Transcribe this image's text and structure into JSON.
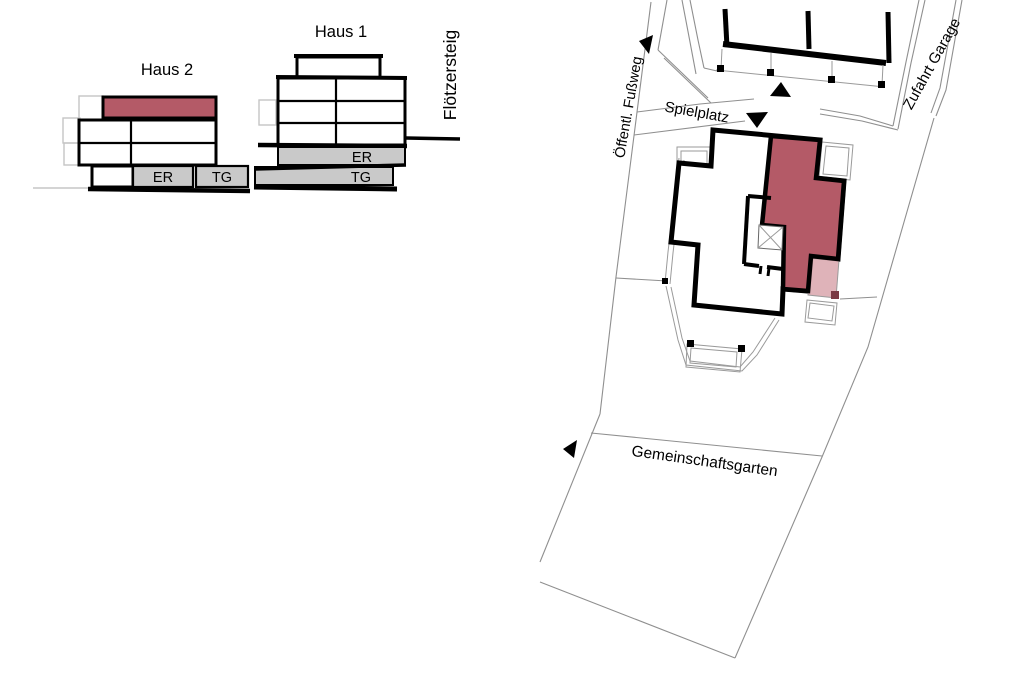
{
  "sections": {
    "haus2": {
      "title": "Haus 2",
      "er_label": "ER",
      "tg_label": "TG"
    },
    "haus1": {
      "title": "Haus 1",
      "er_label": "ER",
      "tg_label": "TG"
    }
  },
  "site": {
    "street": "Flötzersteig",
    "footpath": "Öffentl. Fußweg",
    "playground": "Spielplatz",
    "garage_access": "Zufahrt Garage",
    "community_garden": "Gemeinschaftsgarten"
  },
  "colors": {
    "highlight": "#b45a67",
    "highlight_light": "#d9a6ad",
    "terrace_corner": "#7a3a44",
    "level_fill": "#c9c9c9",
    "wall": "#000000",
    "context_line": "#8f8f8f",
    "backdrop_line": "#c5c5c5"
  }
}
